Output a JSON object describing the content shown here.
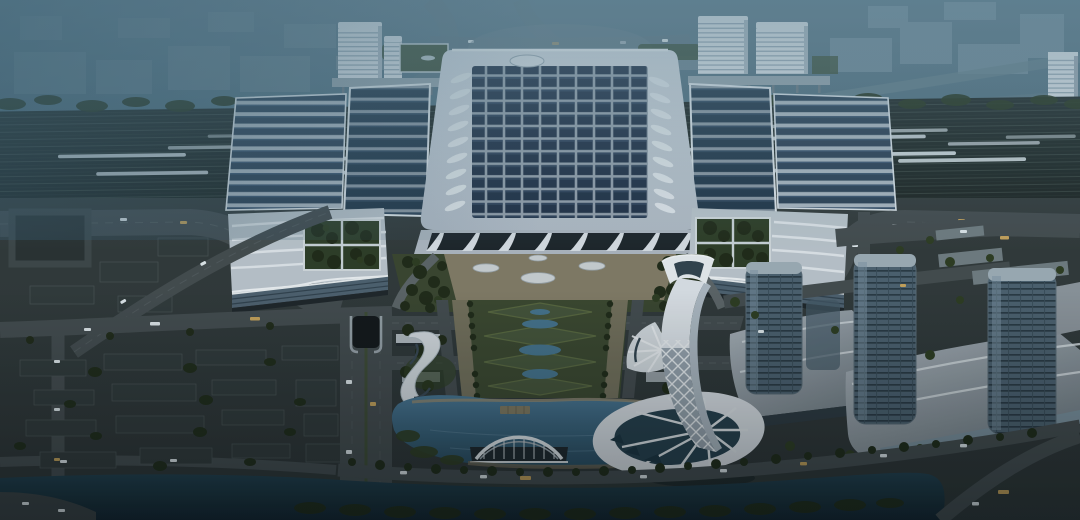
{
  "scene": {
    "description": "Dusk aerial rendering of a large high-speed railway station: solar-panel main roof flanked by platform canopies, trains in the rail yard, twin green-roof wing buildings, landscaped central axis leading to a crescent lake with an arched pavilion, a twisted white lattice landmark tower, glass office towers on podiums, a tree-lined canal in the foreground and a hazy city skyline in fog behind",
    "elements": [
      {
        "name": "distant-city",
        "label": "Hazy city skyline in fog"
      },
      {
        "name": "elevated-offices",
        "label": "White office slabs above the tracks"
      },
      {
        "name": "rail-yard",
        "label": "Rail yard with high-speed trains"
      },
      {
        "name": "station-main-roof",
        "label": "Main hall roof with solar panel grid and oval skylight"
      },
      {
        "name": "platform-canopies",
        "label": "Solar platform canopies and side halls"
      },
      {
        "name": "station-facade",
        "label": "Arched white colonnade facade"
      },
      {
        "name": "green-roof-wings",
        "label": "Twin wing buildings with roof gardens"
      },
      {
        "name": "central-plaza",
        "label": "Forecourt plaza with oval skylights"
      },
      {
        "name": "garden-axis",
        "label": "Landscaped axis with diamond lawns and ponds"
      },
      {
        "name": "lake",
        "label": "Crescent lake with pier and arch pavilion"
      },
      {
        "name": "landmark-tower",
        "label": "Twisted white lattice tower with flared podium"
      },
      {
        "name": "office-towers",
        "label": "Glass towers on angular podiums"
      },
      {
        "name": "s-curve-building",
        "label": "S-shaped lakeside building"
      },
      {
        "name": "canal",
        "label": "Tree-lined canal"
      },
      {
        "name": "roads",
        "label": "Boulevards and loop road with light traffic"
      }
    ]
  },
  "palette": {
    "fog-top": "#5d7b8c",
    "train": "#d9e1e6",
    "tree-dark": "#212b19",
    "tree-light": "#2f3d22",
    "road": "#454c4f",
    "ground": "#333a3b",
    "plaza": "#837c67",
    "lawn": "#3c4830",
    "tower-white": "#dde2e8",
    "glass-dark": "#27404e",
    "car-light": "#e2e9ed",
    "car-amber": "#c9a45c",
    "wing-roof": "#bcc5cd",
    "garden-green": "#2f3e27",
    "block-dark": "#323a3b",
    "office-white": "#e3e8ed",
    "roof-white": "#ccd3db",
    "roof-edge": "#eef1f4",
    "panel-navy": "#202f45",
    "lake-blue": "#41708d",
    "canal-dark": "#1c3746"
  }
}
